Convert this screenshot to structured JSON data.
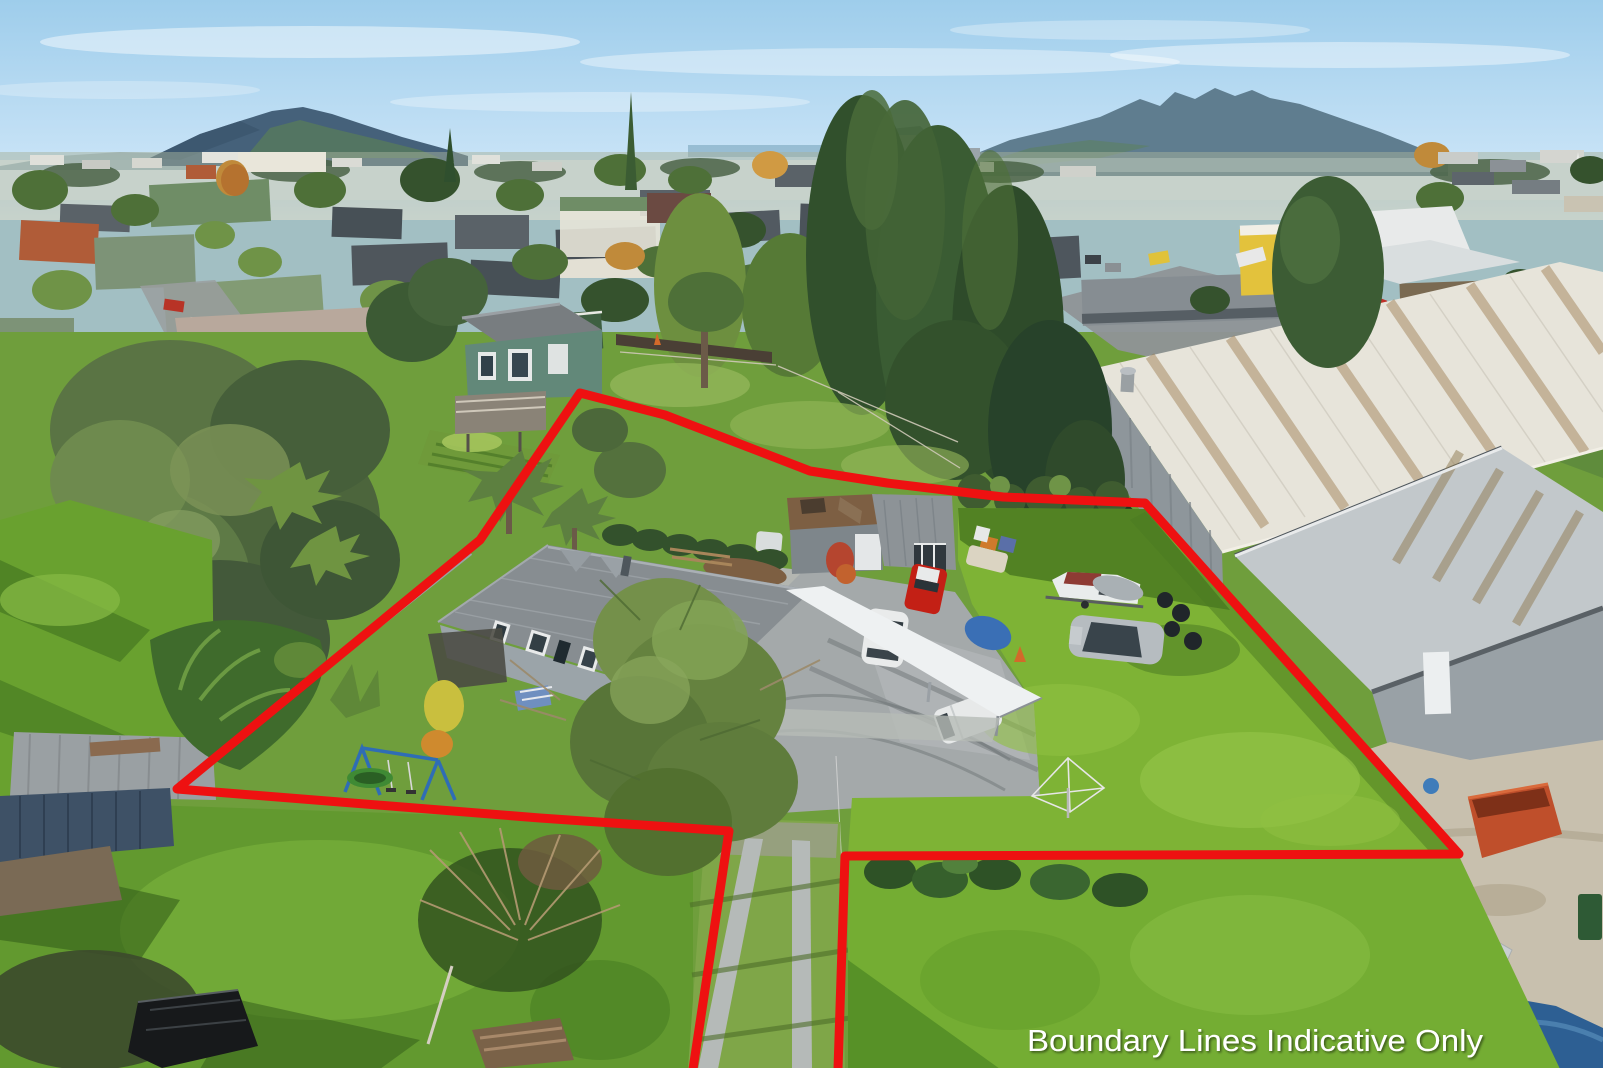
{
  "caption": {
    "text": "Boundary Lines Indicative Only"
  },
  "boundary": {
    "points": "693,1069 729,831 540,818 177,789 480,540 580,393 665,415 810,471 887,483 1003,497 1145,503 1459,854 845,856 838,1069",
    "color": "#ee1111",
    "stroke_width": 9
  },
  "scene": {
    "description": "Aerial drone photograph of a residential property outlined with red indicative boundary lines; grey-roofed house with carport, sheds, gravel driveway with parked red ute, white hatchback, white van, silver sedan and a boat on a trailer; bright green lawns with swing set and trampoline; large grey industrial warehouse with rust-streaked white roof at right; suburban township, dark conifers and distant mountains under a pale blue sky; concrete strip driveway runs to the bottom edge between the boundary lines.",
    "sky_top_color": "#9ecdeb",
    "sky_horizon_color": "#e8f3fb",
    "lawn_color": "#7eb335",
    "warehouse_roof_color": "#e7e4da",
    "house_roof_color": "#878d91"
  }
}
